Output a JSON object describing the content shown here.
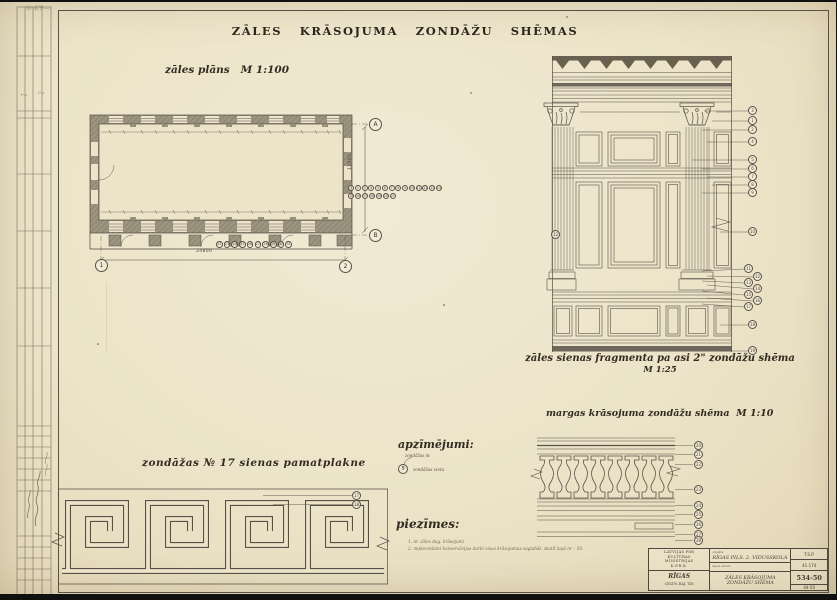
{
  "sheet": {
    "title": "ZĀLES KRĀSOJUMA ZONDĀŽU SHĒMAS",
    "corner_note": "№ 4/9—"
  },
  "plan": {
    "caption": "zāles plāns",
    "scale": "M 1:100",
    "dim_width": "24800",
    "dim_height": "12500",
    "axis_markers": {
      "top": "A",
      "bottom": "B",
      "left": "1",
      "right": "2"
    },
    "callout_row1": [
      "1",
      "2",
      "3",
      "4",
      "5",
      "6",
      "7",
      "8",
      "9",
      "10",
      "11",
      "12",
      "13",
      "14"
    ],
    "callout_row2": [
      "15",
      "16",
      "17",
      "18",
      "19",
      "20",
      "21"
    ],
    "callout_row_bottom": [
      "22",
      "23",
      "24",
      "25",
      "26",
      "27",
      "28",
      "29",
      "30",
      "31"
    ]
  },
  "elevation": {
    "caption": "zāles sienas fragmenta pa asi 2\" zondāžu shēma",
    "scale": "M 1:25",
    "wall_callout": "12",
    "callouts": [
      "3",
      "1",
      "2",
      "4",
      "5",
      "6",
      "7",
      "8",
      "9",
      "10",
      "11",
      "12",
      "13",
      "14",
      "15",
      "16",
      "17",
      "18",
      "19"
    ]
  },
  "balustrade": {
    "caption": "margas krāsojuma zondāžu shēma",
    "scale": "M 1:10",
    "callouts": [
      "20",
      "21",
      "22",
      "23",
      "24",
      "25",
      "26",
      "27",
      "28"
    ]
  },
  "meander": {
    "caption": "zondāžas № 17 sienas pamatplakne",
    "callouts": [
      "17",
      "18"
    ]
  },
  "legend": {
    "heading": "apzīmējumi:",
    "pointer_label": "zondāžas №",
    "sample_number": "5",
    "sample_label": "zondāžas vieta"
  },
  "notes": {
    "heading": "piezīmes:",
    "items": [
      "1. nr. zāles dug. krāsojumi",
      "2. nepieciešami konservācijas darbi visus krāsojumus saglabāt. skatīt lapā nr – 50."
    ]
  },
  "titleblock": {
    "org_lines": [
      "LATVIJAS PSR",
      "KULTŪRAS",
      "MINISTRIJAS",
      "K.P.R.K."
    ],
    "city": "RĪGAS",
    "dept": "CELTN. RAJ. TIN",
    "object_label": "objekts",
    "object": "RĪGAS PILS. 2. VIDUSSKOLA",
    "sheet_label": "lapas saturs",
    "sheet_title": "ZĀLES KRĀSOJUMA ZONDĀŽU SHĒMA",
    "code1": "T.S.P.",
    "code2": "41-174",
    "number": "534-50",
    "code3": "44-50"
  }
}
